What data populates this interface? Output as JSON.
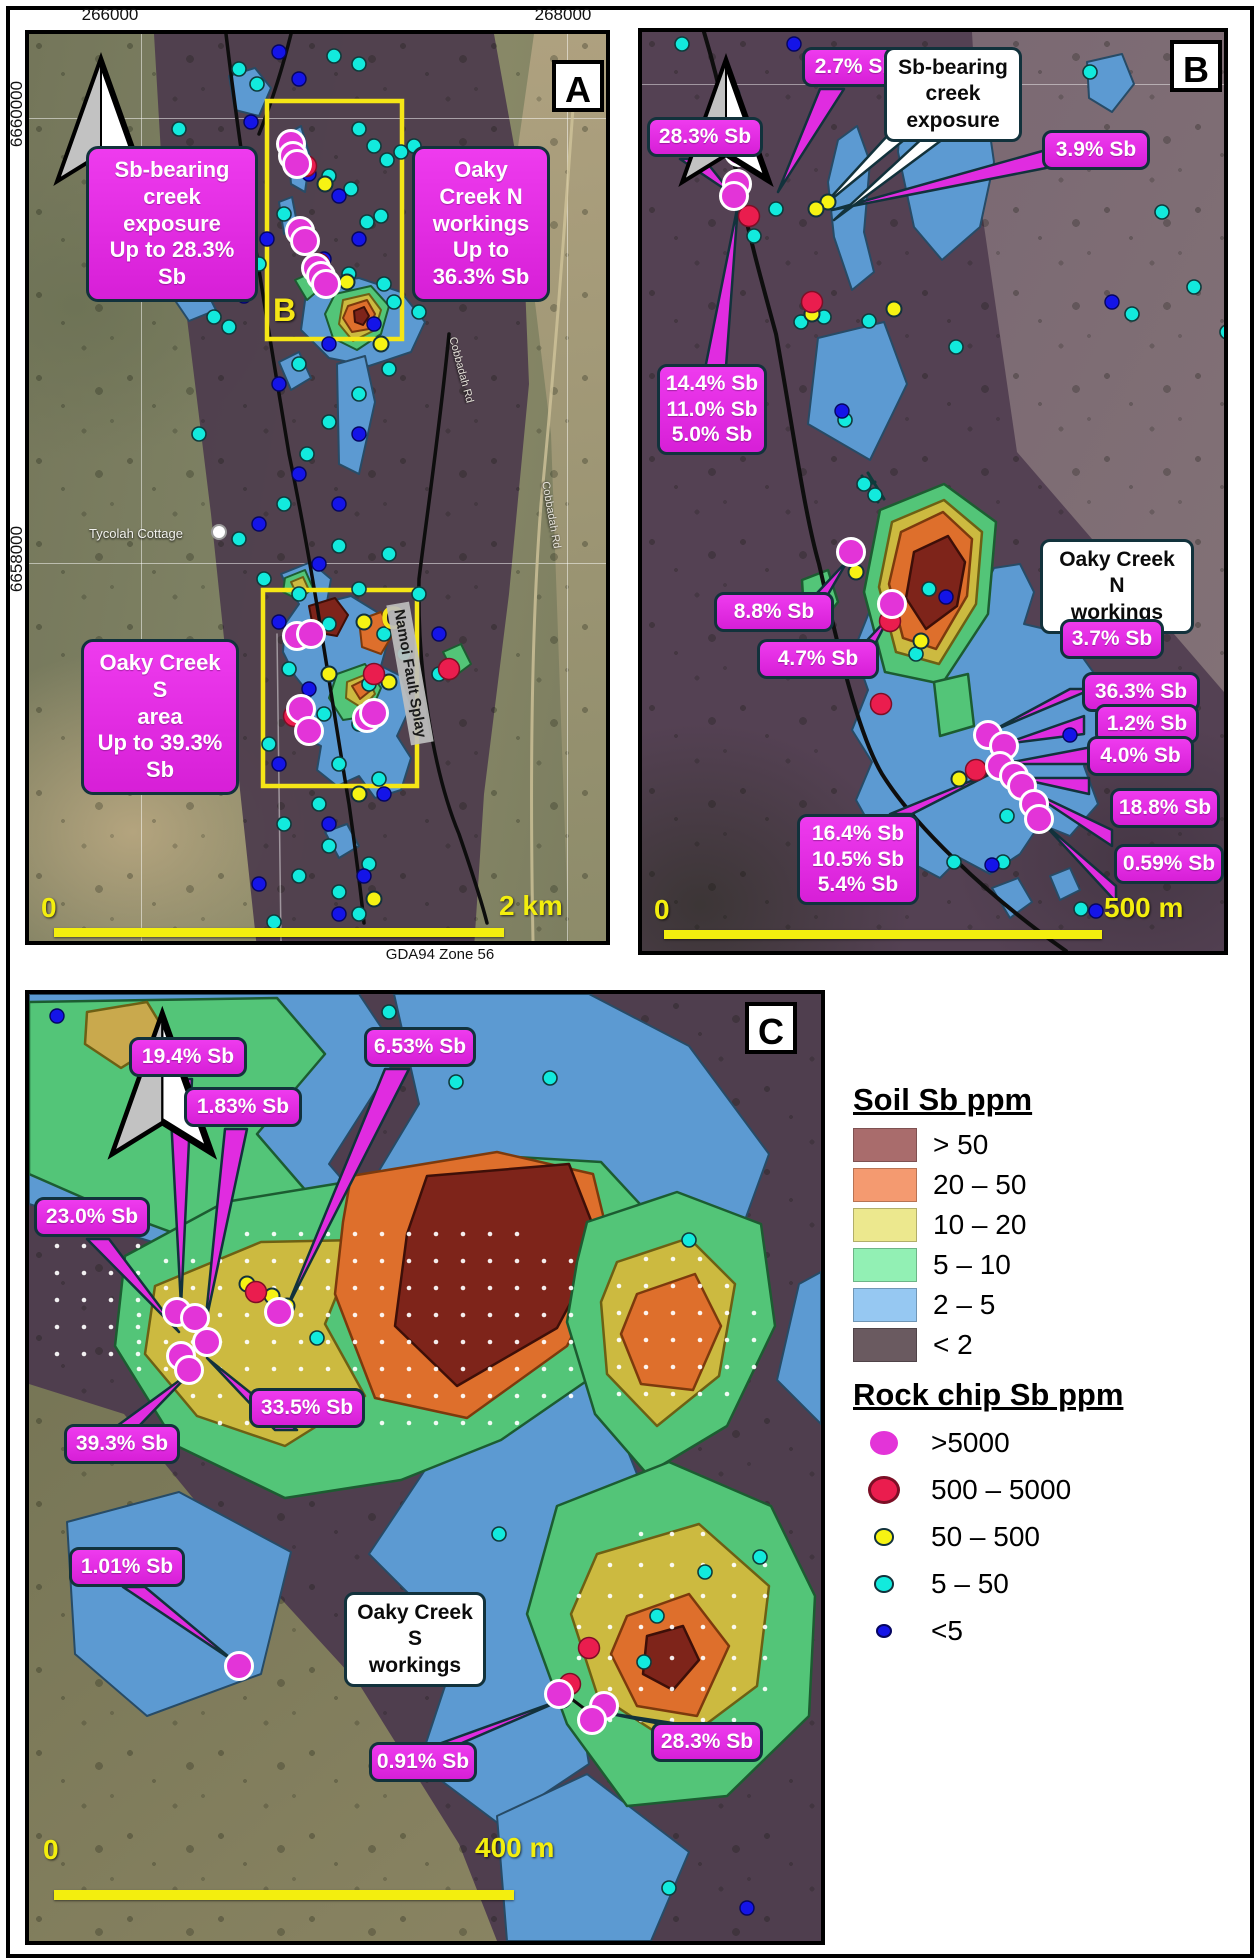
{
  "coords": {
    "top_left": "266000",
    "top_right": "268000",
    "left_upper": "6660000",
    "left_lower": "6658000",
    "datum": "GDA94 Zone 56"
  },
  "panelA": {
    "tag": "A",
    "inset_b": "B",
    "inset_c": "C",
    "callout_creek": "Sb-bearing creek\nexposure\nUp to 28.3% Sb",
    "callout_north": "Oaky Creek N\nworkings\nUp to 36.3% Sb",
    "callout_south": "Oaky Creek S\narea\nUp to 39.3% Sb",
    "fault_label": "Namoi Fault Splay",
    "place_tycolah": "Tycolah Cottage",
    "road_label": "Cobbadah Rd",
    "road_label2": "Cobbadah Rd",
    "scale_zero": "0",
    "scale_end": "2 km"
  },
  "panelB": {
    "tag": "B",
    "white_creek": "Sb-bearing creek\nexposure",
    "white_workings": "Oaky Creek N\nworkings",
    "l27": "2.7% Sb",
    "l283": "28.3% Sb",
    "l39": "3.9% Sb",
    "l144": "14.4% Sb\n11.0% Sb\n5.0% Sb",
    "l88": "8.8% Sb",
    "l47": "4.7% Sb",
    "l37": "3.7% Sb",
    "l363": "36.3% Sb",
    "l12": "1.2% Sb",
    "l40": "4.0% Sb",
    "l188": "18.8% Sb",
    "l059": "0.59% Sb",
    "l164": "16.4% Sb\n10.5% Sb\n5.4% Sb",
    "scale_zero": "0",
    "scale_end": "500 m"
  },
  "panelC": {
    "tag": "C",
    "white_workings": "Oaky Creek S\nworkings",
    "l194": "19.4% Sb",
    "l183": "1.83% Sb",
    "l653": "6.53% Sb",
    "l230": "23.0% Sb",
    "l335": "33.5% Sb",
    "l393": "39.3% Sb",
    "l101": "1.01% Sb",
    "l091": "0.91% Sb",
    "l283": "28.3% Sb",
    "scale_zero": "0",
    "scale_end": "400 m"
  },
  "legend": {
    "soil_title": "Soil Sb ppm",
    "soil_items": [
      {
        "label": "> 50",
        "color": "#a96c6c"
      },
      {
        "label": "20 – 50",
        "color": "#f49a70"
      },
      {
        "label": "10 – 20",
        "color": "#ece88e"
      },
      {
        "label": "5 – 10",
        "color": "#92f0b4"
      },
      {
        "label": "2 – 5",
        "color": "#96c8f2"
      },
      {
        "label": "< 2",
        "color": "#6a5a60"
      }
    ],
    "rock_title": "Rock chip Sb ppm",
    "rock_items": [
      {
        "label": ">5000",
        "color": "#e334d8",
        "size": 34,
        "ring": "#ffffff"
      },
      {
        "label": "500 – 5000",
        "color": "#ea1d4e",
        "size": 32,
        "ring": "#7c0f26"
      },
      {
        "label": "50 – 500",
        "color": "#f6f313",
        "size": 20,
        "ring": "#12323c"
      },
      {
        "label": "5 – 50",
        "color": "#12eadd",
        "size": 20,
        "ring": "#12323c"
      },
      {
        "label": "<5",
        "color": "#1414e8",
        "size": 16,
        "ring": "#050560"
      }
    ]
  }
}
